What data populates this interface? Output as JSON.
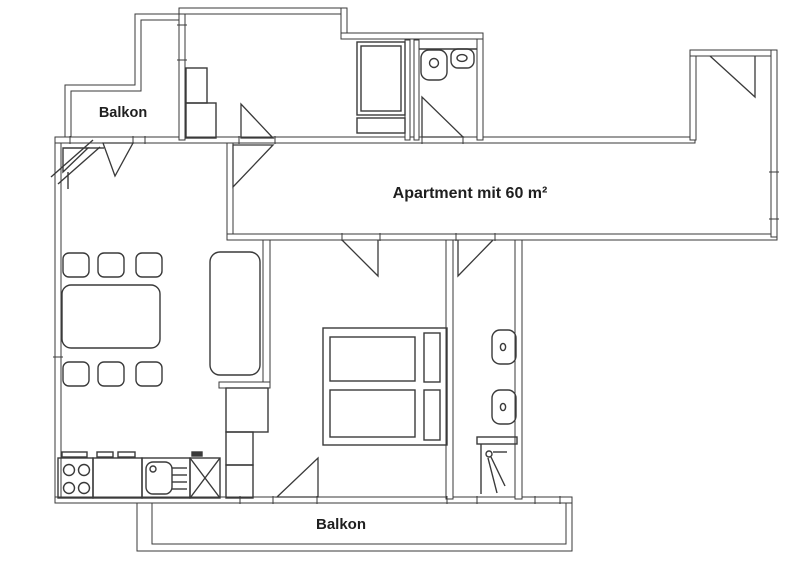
{
  "canvas": {
    "width": 800,
    "height": 571,
    "background": "#ffffff",
    "ink": "#3a3a3a",
    "text_color": "#1f1f1f"
  },
  "labels": {
    "balcony_top": "Balkon",
    "apartment": "Apartment mit 60 m²",
    "balcony_bottom": "Balkon"
  },
  "fixtures": {
    "living_room": [
      "chimney-flue",
      "dining-table",
      "chair-x6",
      "sofa",
      "door-swing-balcony",
      "door-swing-hall"
    ],
    "kitchen": [
      "stove-4-burners",
      "kitchen-counter",
      "kitchen-sink",
      "refrigerator-x-box",
      "kitchen-cabinets"
    ],
    "bedroom": [
      "double-bed",
      "pillows",
      "door-swing-corridor",
      "door-swing-balcony"
    ],
    "bathroom_bottom": [
      "washbasin",
      "toilet",
      "shower",
      "door-swing"
    ],
    "bathroom_top": [
      "washbasin",
      "toilet",
      "door-swing"
    ],
    "upper_room": [
      "wardrobe",
      "shelf-steps",
      "door-swing"
    ],
    "entry": [
      "entrance-door-swing",
      "window-marks"
    ],
    "balconies": [
      "railing-double-line"
    ]
  }
}
